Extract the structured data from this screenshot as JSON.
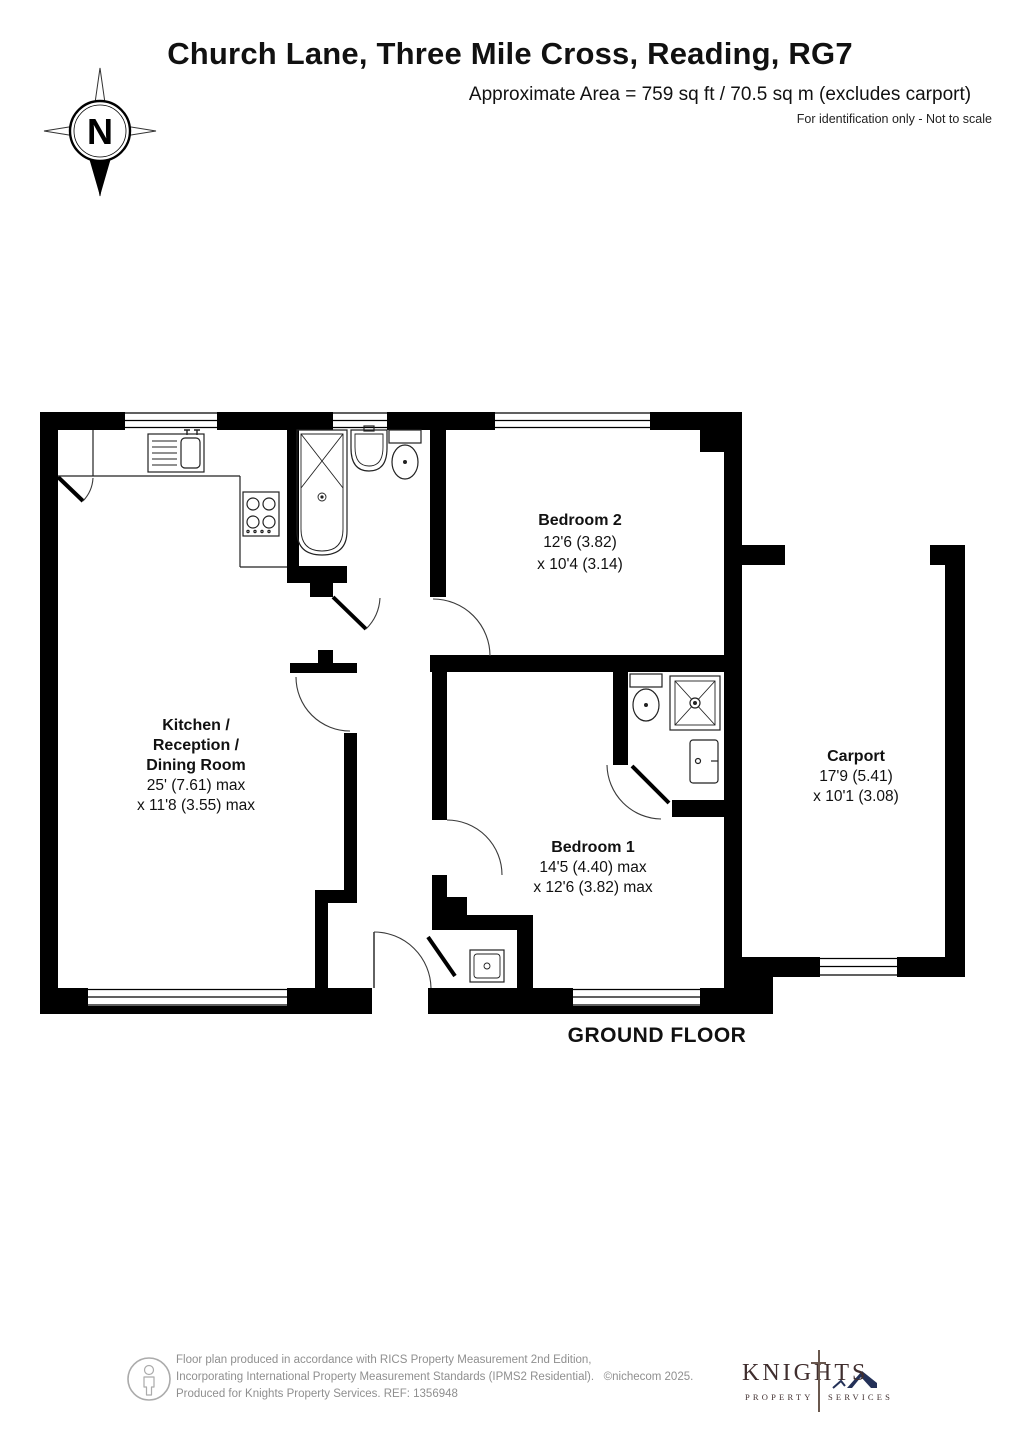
{
  "header": {
    "title": "Church Lane, Three Mile Cross, Reading, RG7",
    "area_line": "Approximate Area = 759 sq ft / 70.5 sq m (excludes carport)",
    "disclaimer": "For identification only - Not to scale"
  },
  "compass": {
    "label": "N"
  },
  "floor_label": "GROUND FLOOR",
  "rooms": {
    "kitchen": {
      "lines": [
        "Kitchen /",
        "Reception /",
        "Dining Room",
        "25' (7.61) max",
        "x 11'8 (3.55) max"
      ]
    },
    "bedroom2": {
      "lines": [
        "Bedroom 2",
        "12'6 (3.82)",
        "x 10'4 (3.14)"
      ]
    },
    "bedroom1": {
      "lines": [
        "Bedroom 1",
        "14'5 (4.40) max",
        "x 12'6 (3.82) max"
      ]
    },
    "carport": {
      "lines": [
        "Carport",
        "17'9 (5.41)",
        "x 10'1 (3.08)"
      ]
    }
  },
  "footer": {
    "line1": "Floor plan produced in accordance with RICS Property Measurement 2nd Edition,",
    "line2": "Incorporating International Property Measurement Standards (IPMS2 Residential).",
    "copyright": "©nichecom 2025.",
    "line3": "Produced for Knights Property Services.   REF:   1356948"
  },
  "logo": {
    "name": "KNIGHTS",
    "sub1": "PROPERTY",
    "sub2": "SERVICES"
  },
  "colors": {
    "wall": "#000000",
    "footer_gray": "#8f8f8f",
    "logo_maroon": "#402e2e",
    "logo_navy": "#243158"
  }
}
